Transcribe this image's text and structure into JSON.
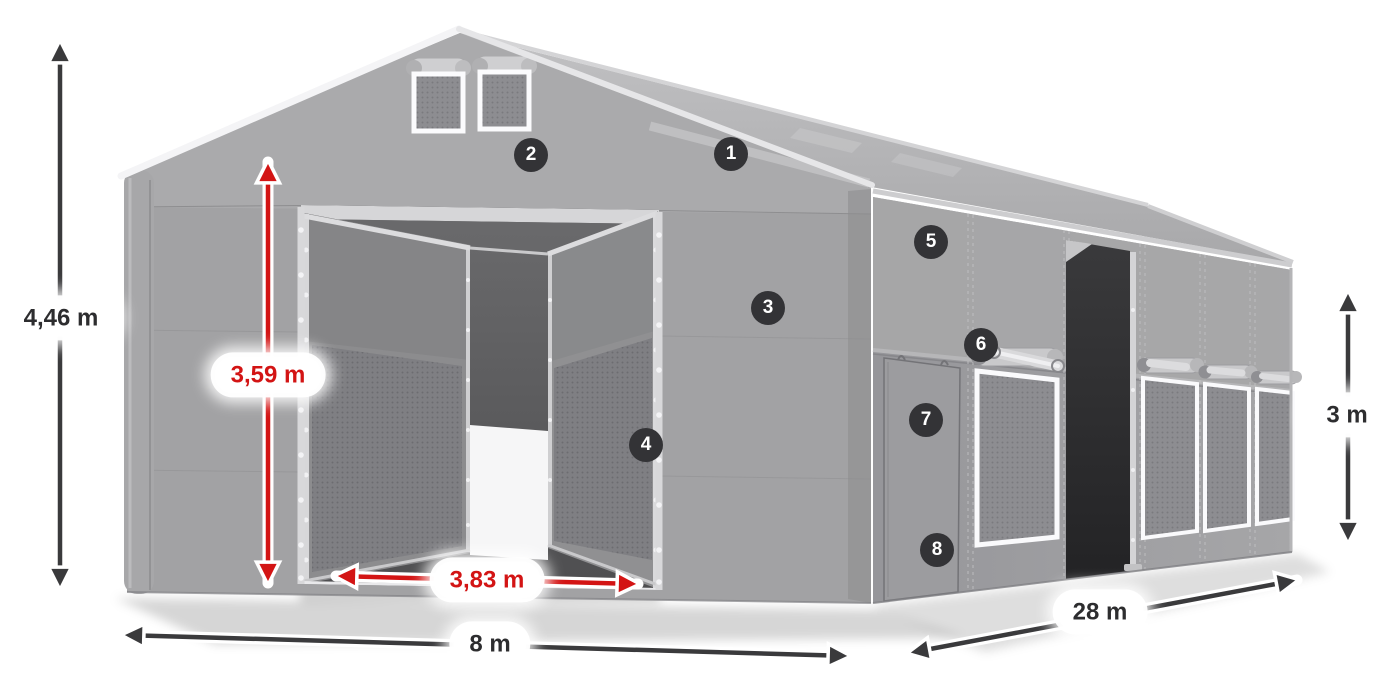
{
  "diagram": {
    "background": "#ffffff",
    "dimension_labels": {
      "total_height": "4,46 m",
      "entrance_height": "3,59 m",
      "entrance_width": "3,83 m",
      "tent_width": "8 m",
      "tent_length": "28 m",
      "side_wall_height": "3 m"
    },
    "feature_markers": [
      {
        "label": "1"
      },
      {
        "label": "2"
      },
      {
        "label": "3"
      },
      {
        "label": "4"
      },
      {
        "label": "5"
      },
      {
        "label": "6"
      },
      {
        "label": "7"
      },
      {
        "label": "8"
      }
    ],
    "colors": {
      "dimension_dark": "#3a3a3c",
      "dimension_red": "#d31414",
      "marker_background": "#333336",
      "marker_text": "#ffffff",
      "tent_fabric": "#a2a2a4"
    }
  }
}
